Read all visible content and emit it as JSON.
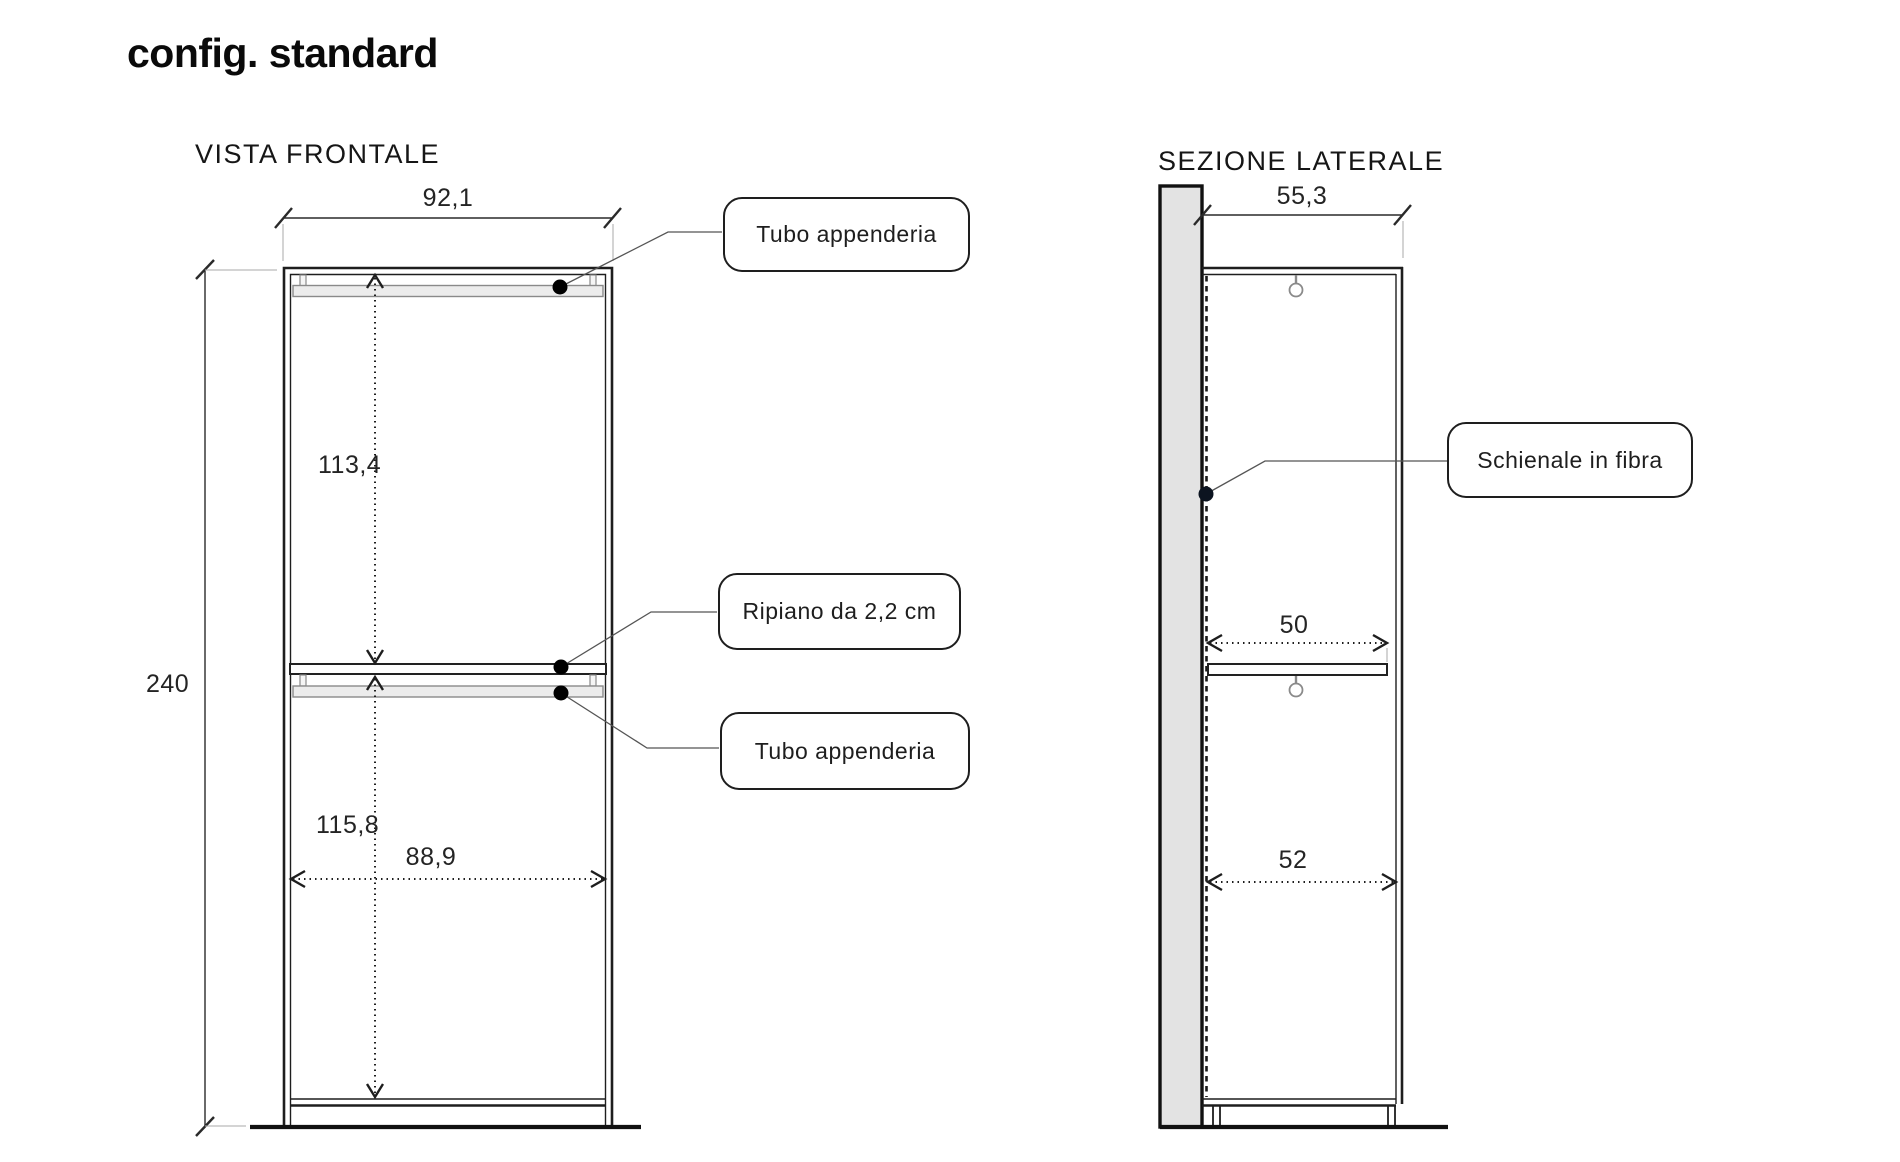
{
  "title": "config. standard",
  "front_view": {
    "label": "VISTA FRONTALE",
    "dimensions": {
      "outer_width": "92,1",
      "total_height": "240",
      "upper_section_height": "113,4",
      "lower_section_height": "115,8",
      "inner_width": "88,9"
    },
    "callouts": {
      "top_tube": "Tubo appenderia",
      "shelf": "Ripiano da 2,2 cm",
      "bottom_tube": "Tubo appenderia"
    }
  },
  "side_view": {
    "label": "SEZIONE LATERALE",
    "dimensions": {
      "outer_depth": "55,3",
      "shelf_depth": "50",
      "lower_inner_depth": "52"
    },
    "callouts": {
      "back_panel": "Schienale in fibra"
    }
  },
  "colors": {
    "line": "#1e1e1e",
    "thin_extension": "#aaaaaa",
    "panel_fill": "#e3e3e3",
    "tube_fill": "#ececec",
    "leader": "#555555",
    "background": "#ffffff"
  }
}
